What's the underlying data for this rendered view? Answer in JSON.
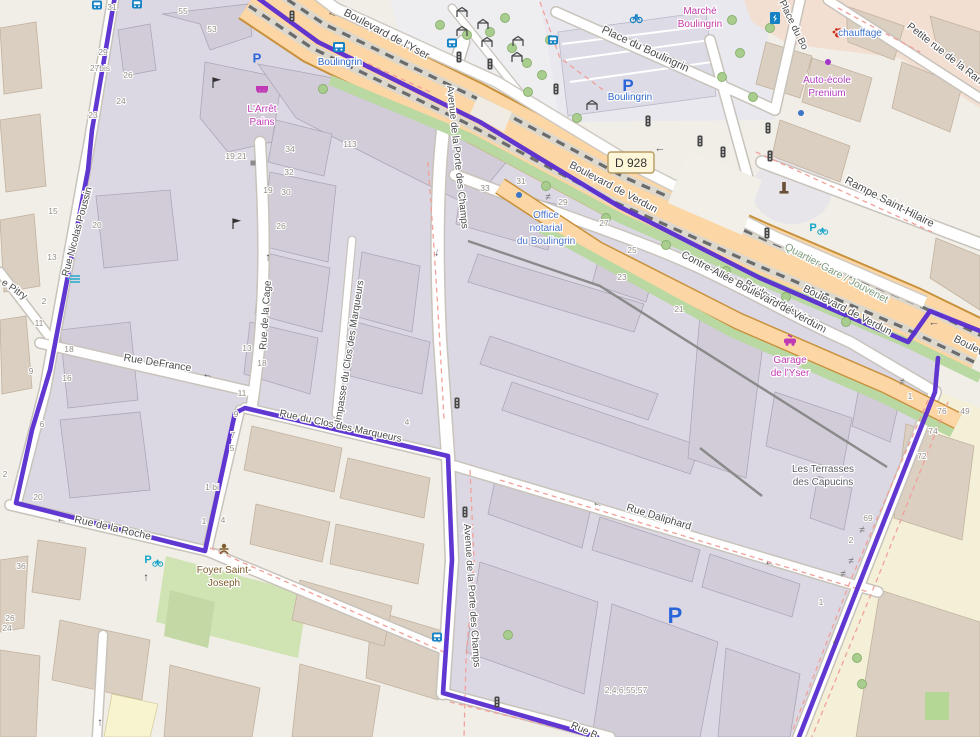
{
  "map": {
    "colors": {
      "boundary_purple": "#5b2fd0",
      "primary_road_orange": "#fcd6a4",
      "inside_area_lavender": "#dcd8e3",
      "outside_area_beige": "#f1eee8",
      "retail_area_pink": "#f3ded2",
      "school_area_cream": "#f4f0d8",
      "building_lavender": "#d2ccd8",
      "building_beige": "#dacfc1",
      "grass_green": "#cfe3b3",
      "tree_green": "#a9cd8e",
      "transit_blue": "#2e66c6",
      "shop_magenta": "#ba3bbf",
      "red_dashed": "#f2a09a",
      "tram_dash_gray": "#666666"
    },
    "road_ref": {
      "text": "D 928",
      "x": 608,
      "y": 152
    },
    "street_labels": [
      {
        "text": "Boulevard de l'Yser",
        "x": 385,
        "y": 37,
        "rot": 28,
        "size": 11
      },
      {
        "text": "Place du Boulingrin",
        "x": 644,
        "y": 52,
        "rot": 25,
        "size": 11
      },
      {
        "text": "Petite rue de la Ran",
        "x": 943,
        "y": 56,
        "rot": 38,
        "size": 10.5
      },
      {
        "text": "Rampe Saint-Hilaire",
        "x": 888,
        "y": 205,
        "rot": 27,
        "size": 11
      },
      {
        "text": "Boulevard de Verdun",
        "x": 612,
        "y": 190,
        "rot": 28,
        "size": 10.5
      },
      {
        "text": "Boulevard de Verdun",
        "x": 846,
        "y": 313,
        "rot": 27,
        "size": 10.5
      },
      {
        "text": "Boulevard de Verdun",
        "x": 784,
        "y": 309,
        "rot": 31,
        "size": 10
      },
      {
        "text": "Contre-Allée Boulevard de Verdun",
        "x": 751,
        "y": 294,
        "rot": 28,
        "size": 10.5
      },
      {
        "text": "Quartier Gare / Jouvenet",
        "x": 835,
        "y": 276,
        "rot": 28,
        "size": 10.5,
        "cls": "quartier"
      },
      {
        "text": "Boulev",
        "x": 953,
        "y": 341,
        "rot": 27,
        "anchor": "start",
        "size": 10.5
      },
      {
        "text": "Avenue de la Porte des Champs",
        "x": 447,
        "y": 86,
        "rot": 84,
        "anchor": "start",
        "size": 10
      },
      {
        "text": "Avenue de la Porte des Champs",
        "x": 464,
        "y": 524,
        "rot": 86,
        "anchor": "start",
        "size": 10
      },
      {
        "text": "Impasse du Clos des Marqueurs",
        "x": 341,
        "y": 423,
        "rot": -81,
        "anchor": "start",
        "size": 10
      },
      {
        "text": "Rue de la Cage",
        "x": 266,
        "y": 350,
        "rot": -86,
        "anchor": "start",
        "size": 10
      },
      {
        "text": "Rue Nicolas Poussin",
        "x": 68,
        "y": 277,
        "rot": -75,
        "anchor": "start",
        "size": 10
      },
      {
        "text": "e Pitry",
        "x": 1,
        "y": 284,
        "rot": 34,
        "anchor": "start",
        "size": 10
      },
      {
        "text": "Rue DeFrance",
        "x": 157,
        "y": 366,
        "rot": 9,
        "size": 10.5
      },
      {
        "text": "Rue du Clos des Marqueurs",
        "x": 340,
        "y": 429,
        "rot": 12,
        "size": 10
      },
      {
        "text": "Rue Daliphard",
        "x": 658,
        "y": 520,
        "rot": 17,
        "size": 10.5
      },
      {
        "text": "Rue de la Roche",
        "x": 112,
        "y": 531,
        "rot": 13,
        "size": 10.5
      },
      {
        "text": "Rue B",
        "x": 583,
        "y": 733,
        "rot": 24,
        "size": 10
      },
      {
        "text": "Place du Bo",
        "x": 779,
        "y": 2,
        "rot": 64,
        "anchor": "start",
        "size": 10
      }
    ],
    "poi_labels": [
      {
        "id": "tram-stop-boulingrin",
        "lines": [
          "Boulingrin"
        ],
        "x": 340,
        "y": 65,
        "color": "#2e66c6",
        "size": 11
      },
      {
        "id": "parking-boulingrin",
        "lines": [
          "Boulingrin"
        ],
        "x": 630,
        "y": 100,
        "color": "#2e66c6",
        "size": 11
      },
      {
        "id": "office-notarial",
        "lines": [
          "Office",
          "notarial",
          "du Boulingrin"
        ],
        "x": 546,
        "y": 218,
        "color": "#4a72c8",
        "size": 10
      },
      {
        "id": "marche-boulingrin",
        "lines": [
          "Marché",
          "Boulingrin"
        ],
        "x": 700,
        "y": 14,
        "color": "#c23ba8",
        "size": 10
      },
      {
        "id": "auto-ecole",
        "lines": [
          "Auto-école",
          "Prenium"
        ],
        "x": 827,
        "y": 83,
        "color": "#b03bbf",
        "size": 10
      },
      {
        "id": "chauffage",
        "lines": [
          "chauffage"
        ],
        "x": 860,
        "y": 36,
        "color": "#3f74cc",
        "size": 10
      },
      {
        "id": "garage-yser",
        "lines": [
          "Garage",
          "de l'Yser"
        ],
        "x": 790,
        "y": 363,
        "color": "#c13ab5",
        "size": 10
      },
      {
        "id": "arret-pains",
        "lines": [
          "L'Arrêt",
          "Pains"
        ],
        "x": 262,
        "y": 112,
        "color": "#c13ab5",
        "size": 10
      },
      {
        "id": "terrasses-capucins",
        "lines": [
          "Les Terrasses",
          "des Capucins"
        ],
        "x": 823,
        "y": 472,
        "color": "#5c5c64",
        "size": 10
      },
      {
        "id": "foyer-saint-joseph",
        "lines": [
          "Foyer Saint-",
          "Joseph"
        ],
        "x": 224,
        "y": 573,
        "color": "#7d5a2b",
        "size": 10
      }
    ],
    "house_numbers": [
      {
        "t": "31",
        "x": 112,
        "y": 10
      },
      {
        "t": "55",
        "x": 183,
        "y": 14
      },
      {
        "t": "53",
        "x": 212,
        "y": 32
      },
      {
        "t": "29",
        "x": 103,
        "y": 55
      },
      {
        "t": "27bis",
        "x": 100,
        "y": 71
      },
      {
        "t": "26",
        "x": 128,
        "y": 78
      },
      {
        "t": "24",
        "x": 121,
        "y": 104
      },
      {
        "t": "23",
        "x": 93,
        "y": 118
      },
      {
        "t": "15",
        "x": 53,
        "y": 214
      },
      {
        "t": "20",
        "x": 97,
        "y": 228
      },
      {
        "t": "13",
        "x": 52,
        "y": 260
      },
      {
        "t": "2",
        "x": 44,
        "y": 304
      },
      {
        "t": "11",
        "x": 39,
        "y": 326
      },
      {
        "t": "18",
        "x": 69,
        "y": 352
      },
      {
        "t": "16",
        "x": 67,
        "y": 381
      },
      {
        "t": "9",
        "x": 31,
        "y": 374
      },
      {
        "t": "6",
        "x": 42,
        "y": 427
      },
      {
        "t": "2",
        "x": 5,
        "y": 477
      },
      {
        "t": "20",
        "x": 38,
        "y": 500
      },
      {
        "t": "36",
        "x": 21,
        "y": 569
      },
      {
        "t": "26",
        "x": 10,
        "y": 621
      },
      {
        "t": "24",
        "x": 7,
        "y": 631
      },
      {
        "t": "19;21",
        "x": 236,
        "y": 159
      },
      {
        "t": "34",
        "x": 290,
        "y": 152
      },
      {
        "t": "32",
        "x": 289,
        "y": 175
      },
      {
        "t": "19",
        "x": 268,
        "y": 193
      },
      {
        "t": "30",
        "x": 286,
        "y": 195
      },
      {
        "t": "26",
        "x": 281,
        "y": 229
      },
      {
        "t": "113",
        "x": 350,
        "y": 147
      },
      {
        "t": "13",
        "x": 247,
        "y": 351
      },
      {
        "t": "18",
        "x": 262,
        "y": 366
      },
      {
        "t": "11",
        "x": 242,
        "y": 396
      },
      {
        "t": "9",
        "x": 236,
        "y": 417
      },
      {
        "t": "7",
        "x": 233,
        "y": 438
      },
      {
        "t": "5",
        "x": 232,
        "y": 451
      },
      {
        "t": "1 bi",
        "x": 212,
        "y": 490
      },
      {
        "t": "1",
        "x": 204,
        "y": 524
      },
      {
        "t": "4",
        "x": 223,
        "y": 523
      },
      {
        "t": "4",
        "x": 407,
        "y": 425
      },
      {
        "t": "33",
        "x": 485,
        "y": 191
      },
      {
        "t": "31",
        "x": 521,
        "y": 184
      },
      {
        "t": "29",
        "x": 563,
        "y": 205
      },
      {
        "t": "27",
        "x": 604,
        "y": 226
      },
      {
        "t": "25",
        "x": 632,
        "y": 253
      },
      {
        "t": "23",
        "x": 622,
        "y": 280
      },
      {
        "t": "21",
        "x": 679,
        "y": 312
      },
      {
        "t": "1",
        "x": 910,
        "y": 399
      },
      {
        "t": "76",
        "x": 942,
        "y": 414
      },
      {
        "t": "49",
        "x": 965,
        "y": 414
      },
      {
        "t": "74",
        "x": 933,
        "y": 434
      },
      {
        "t": "72",
        "x": 922,
        "y": 459
      },
      {
        "t": "69",
        "x": 868,
        "y": 521
      },
      {
        "t": "2",
        "x": 851,
        "y": 543
      },
      {
        "t": "1",
        "x": 821,
        "y": 605
      },
      {
        "t": "2,4,6,55,57",
        "x": 626,
        "y": 693
      }
    ],
    "icons": [
      {
        "type": "traffic-light",
        "x": 292,
        "y": 16
      },
      {
        "type": "traffic-light",
        "x": 459,
        "y": 57
      },
      {
        "type": "traffic-light",
        "x": 490,
        "y": 64
      },
      {
        "type": "traffic-light",
        "x": 556,
        "y": 89
      },
      {
        "type": "traffic-light",
        "x": 648,
        "y": 121
      },
      {
        "type": "traffic-light",
        "x": 700,
        "y": 141
      },
      {
        "type": "traffic-light",
        "x": 723,
        "y": 152
      },
      {
        "type": "traffic-light",
        "x": 768,
        "y": 128
      },
      {
        "type": "traffic-light",
        "x": 770,
        "y": 156
      },
      {
        "type": "traffic-light",
        "x": 767,
        "y": 233
      },
      {
        "type": "traffic-light",
        "x": 457,
        "y": 403
      },
      {
        "type": "traffic-light",
        "x": 465,
        "y": 512
      },
      {
        "type": "traffic-light",
        "x": 497,
        "y": 702
      },
      {
        "type": "tram-stop",
        "x": 339,
        "y": 47
      },
      {
        "type": "bus-stop",
        "x": 452,
        "y": 43
      },
      {
        "type": "bus-stop",
        "x": 553,
        "y": 40
      },
      {
        "type": "bus-stop",
        "x": 437,
        "y": 637
      },
      {
        "type": "bus-stop",
        "x": 97,
        "y": 5
      },
      {
        "type": "bus-stop",
        "x": 137,
        "y": 4
      },
      {
        "type": "parking",
        "x": 257,
        "y": 58,
        "s": 13
      },
      {
        "type": "parking",
        "x": 628,
        "y": 85,
        "s": 17
      },
      {
        "type": "parking",
        "x": 675,
        "y": 615,
        "s": 22
      },
      {
        "type": "bicycle-parking",
        "x": 152,
        "y": 560
      },
      {
        "type": "bicycle-parking",
        "x": 817,
        "y": 228
      },
      {
        "type": "bicycle-rental",
        "x": 636,
        "y": 18
      },
      {
        "type": "charging-station",
        "x": 775,
        "y": 18
      },
      {
        "type": "veterinary",
        "x": 838,
        "y": 33
      },
      {
        "type": "monument",
        "x": 784,
        "y": 189
      },
      {
        "type": "gate",
        "x": 548,
        "y": 197
      },
      {
        "type": "gate",
        "x": 902,
        "y": 382
      },
      {
        "type": "gate",
        "x": 862,
        "y": 530
      },
      {
        "type": "gate",
        "x": 851,
        "y": 561
      },
      {
        "type": "gate",
        "x": 843,
        "y": 574
      },
      {
        "type": "flag",
        "x": 213,
        "y": 86
      },
      {
        "type": "flag",
        "x": 233,
        "y": 227
      },
      {
        "type": "shelter",
        "x": 462,
        "y": 13
      },
      {
        "type": "shelter",
        "x": 483,
        "y": 25
      },
      {
        "type": "shelter",
        "x": 462,
        "y": 32
      },
      {
        "type": "shelter",
        "x": 487,
        "y": 43
      },
      {
        "type": "shelter",
        "x": 518,
        "y": 42
      },
      {
        "type": "shelter",
        "x": 517,
        "y": 58
      },
      {
        "type": "shelter",
        "x": 592,
        "y": 106
      },
      {
        "type": "picnic-table",
        "x": 75,
        "y": 279
      },
      {
        "type": "person",
        "x": 224,
        "y": 550
      },
      {
        "type": "car-repair",
        "x": 790,
        "y": 341
      },
      {
        "type": "shop-awning",
        "x": 262,
        "y": 90
      },
      {
        "type": "dot-blue",
        "x": 801,
        "y": 113
      },
      {
        "type": "dot-blue",
        "x": 519,
        "y": 195
      },
      {
        "type": "dot-purple",
        "x": 828,
        "y": 62
      },
      {
        "type": "dot-gray",
        "x": 253,
        "y": 163
      },
      {
        "type": "arrow-left",
        "x": 333,
        "y": 13,
        "r": 28
      },
      {
        "type": "arrow-left",
        "x": 934,
        "y": 322,
        "r": 0
      },
      {
        "type": "arrow-left",
        "x": 432,
        "y": 449,
        "r": 12
      },
      {
        "type": "arrow-left",
        "x": 208,
        "y": 374,
        "r": 9
      },
      {
        "type": "arrow-left",
        "x": 598,
        "y": 503,
        "r": 17
      },
      {
        "type": "arrow-left",
        "x": 62,
        "y": 519,
        "r": 13
      },
      {
        "type": "arrow-left",
        "x": 660,
        "y": 148,
        "r": 0
      },
      {
        "type": "arrow-left",
        "x": 770,
        "y": 562,
        "r": 13
      },
      {
        "type": "arrow-up",
        "x": 268,
        "y": 257,
        "r": 0
      },
      {
        "type": "arrow-up",
        "x": 100,
        "y": 722,
        "r": 0
      },
      {
        "type": "arrow-up",
        "x": 146,
        "y": 577,
        "r": 0
      },
      {
        "type": "arrow-down",
        "x": 437,
        "y": 252,
        "r": 8
      },
      {
        "type": "arrow-down",
        "x": 835,
        "y": 640,
        "r": 20
      }
    ],
    "trees": [
      [
        323,
        89
      ],
      [
        440,
        25
      ],
      [
        467,
        35
      ],
      [
        490,
        32
      ],
      [
        505,
        18
      ],
      [
        512,
        48
      ],
      [
        527,
        63
      ],
      [
        542,
        75
      ],
      [
        550,
        40
      ],
      [
        577,
        118
      ],
      [
        528,
        92
      ],
      [
        732,
        20
      ],
      [
        770,
        28
      ],
      [
        753,
        97
      ],
      [
        722,
        77
      ],
      [
        740,
        53
      ],
      [
        546,
        186
      ],
      [
        606,
        218
      ],
      [
        666,
        245
      ],
      [
        726,
        271
      ],
      [
        786,
        297
      ],
      [
        846,
        322
      ],
      [
        508,
        635
      ],
      [
        857,
        658
      ],
      [
        862,
        684
      ]
    ]
  }
}
